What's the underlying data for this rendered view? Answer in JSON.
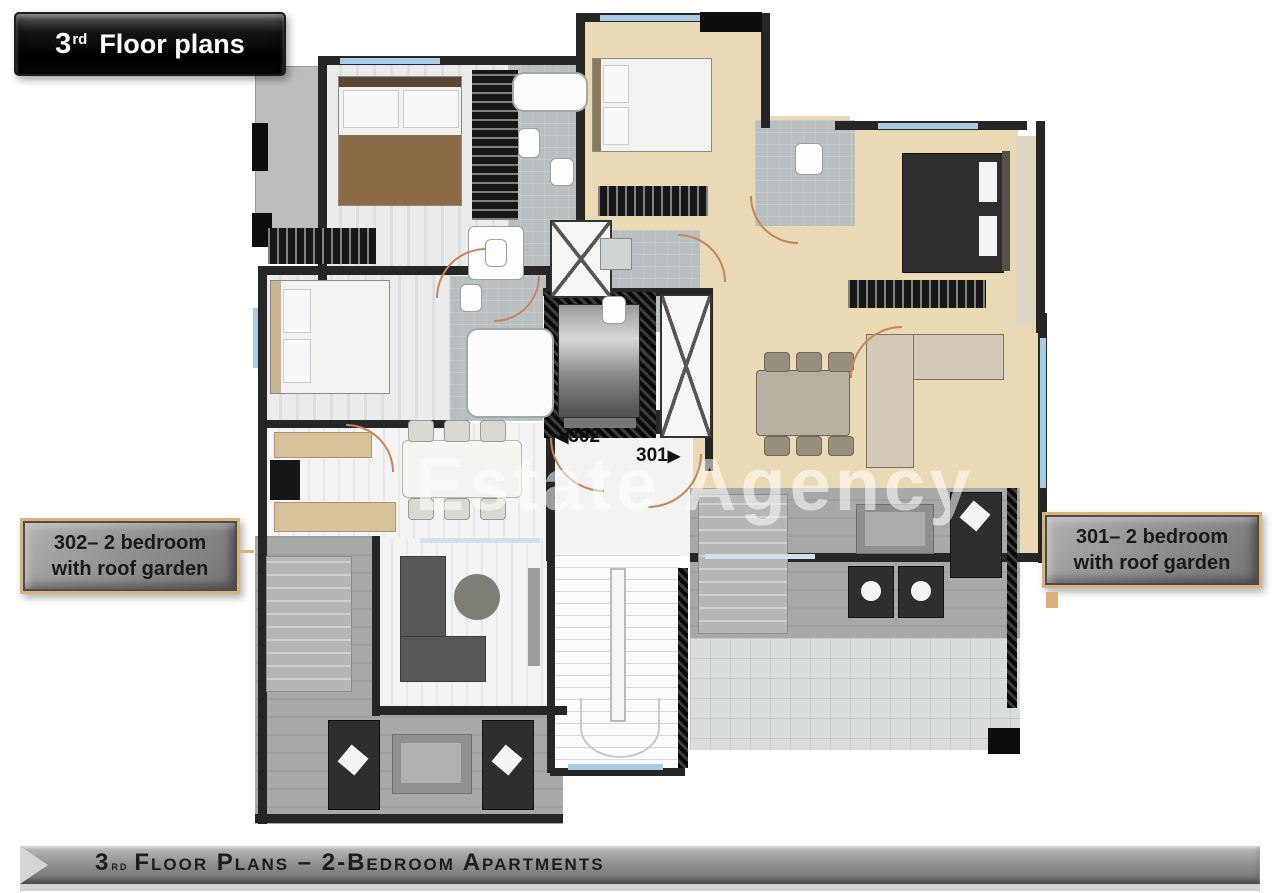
{
  "title_banner": {
    "number": "3",
    "ordinal": "rd",
    "label": "Floor plans"
  },
  "apartment_labels": {
    "left": {
      "line1": "302– 2 bedroom",
      "line2": "with roof garden"
    },
    "right": {
      "line1": "301– 2 bedroom",
      "line2": "with roof garden"
    }
  },
  "plan": {
    "door_tags": {
      "left": {
        "arrow": "◀",
        "number": "302"
      },
      "right": {
        "number": "301",
        "arrow": "▶"
      }
    },
    "watermark": "Estate Agency"
  },
  "footer_banner": {
    "number": "3",
    "ordinal": "rd",
    "label": "Floor Plans – 2-Bedroom Apartments"
  },
  "colors": {
    "wall": "#262626",
    "black": "#0d0d0d",
    "beige": "#e9d9b4",
    "bath": "#b9bec0",
    "tile": "#dadeda",
    "door-arc": "#c8845a",
    "window": "#a9cbe4",
    "accent-tan": "#d7b27c",
    "label-text": "#1a1a1a",
    "footer-text": "#1d1d1d",
    "blanket": "#8b6b46",
    "counter": "#d6c298",
    "dark-furniture": "#2e2e2e",
    "sofa-gray": "#585858",
    "sofa-tan": "#d2cab6"
  }
}
